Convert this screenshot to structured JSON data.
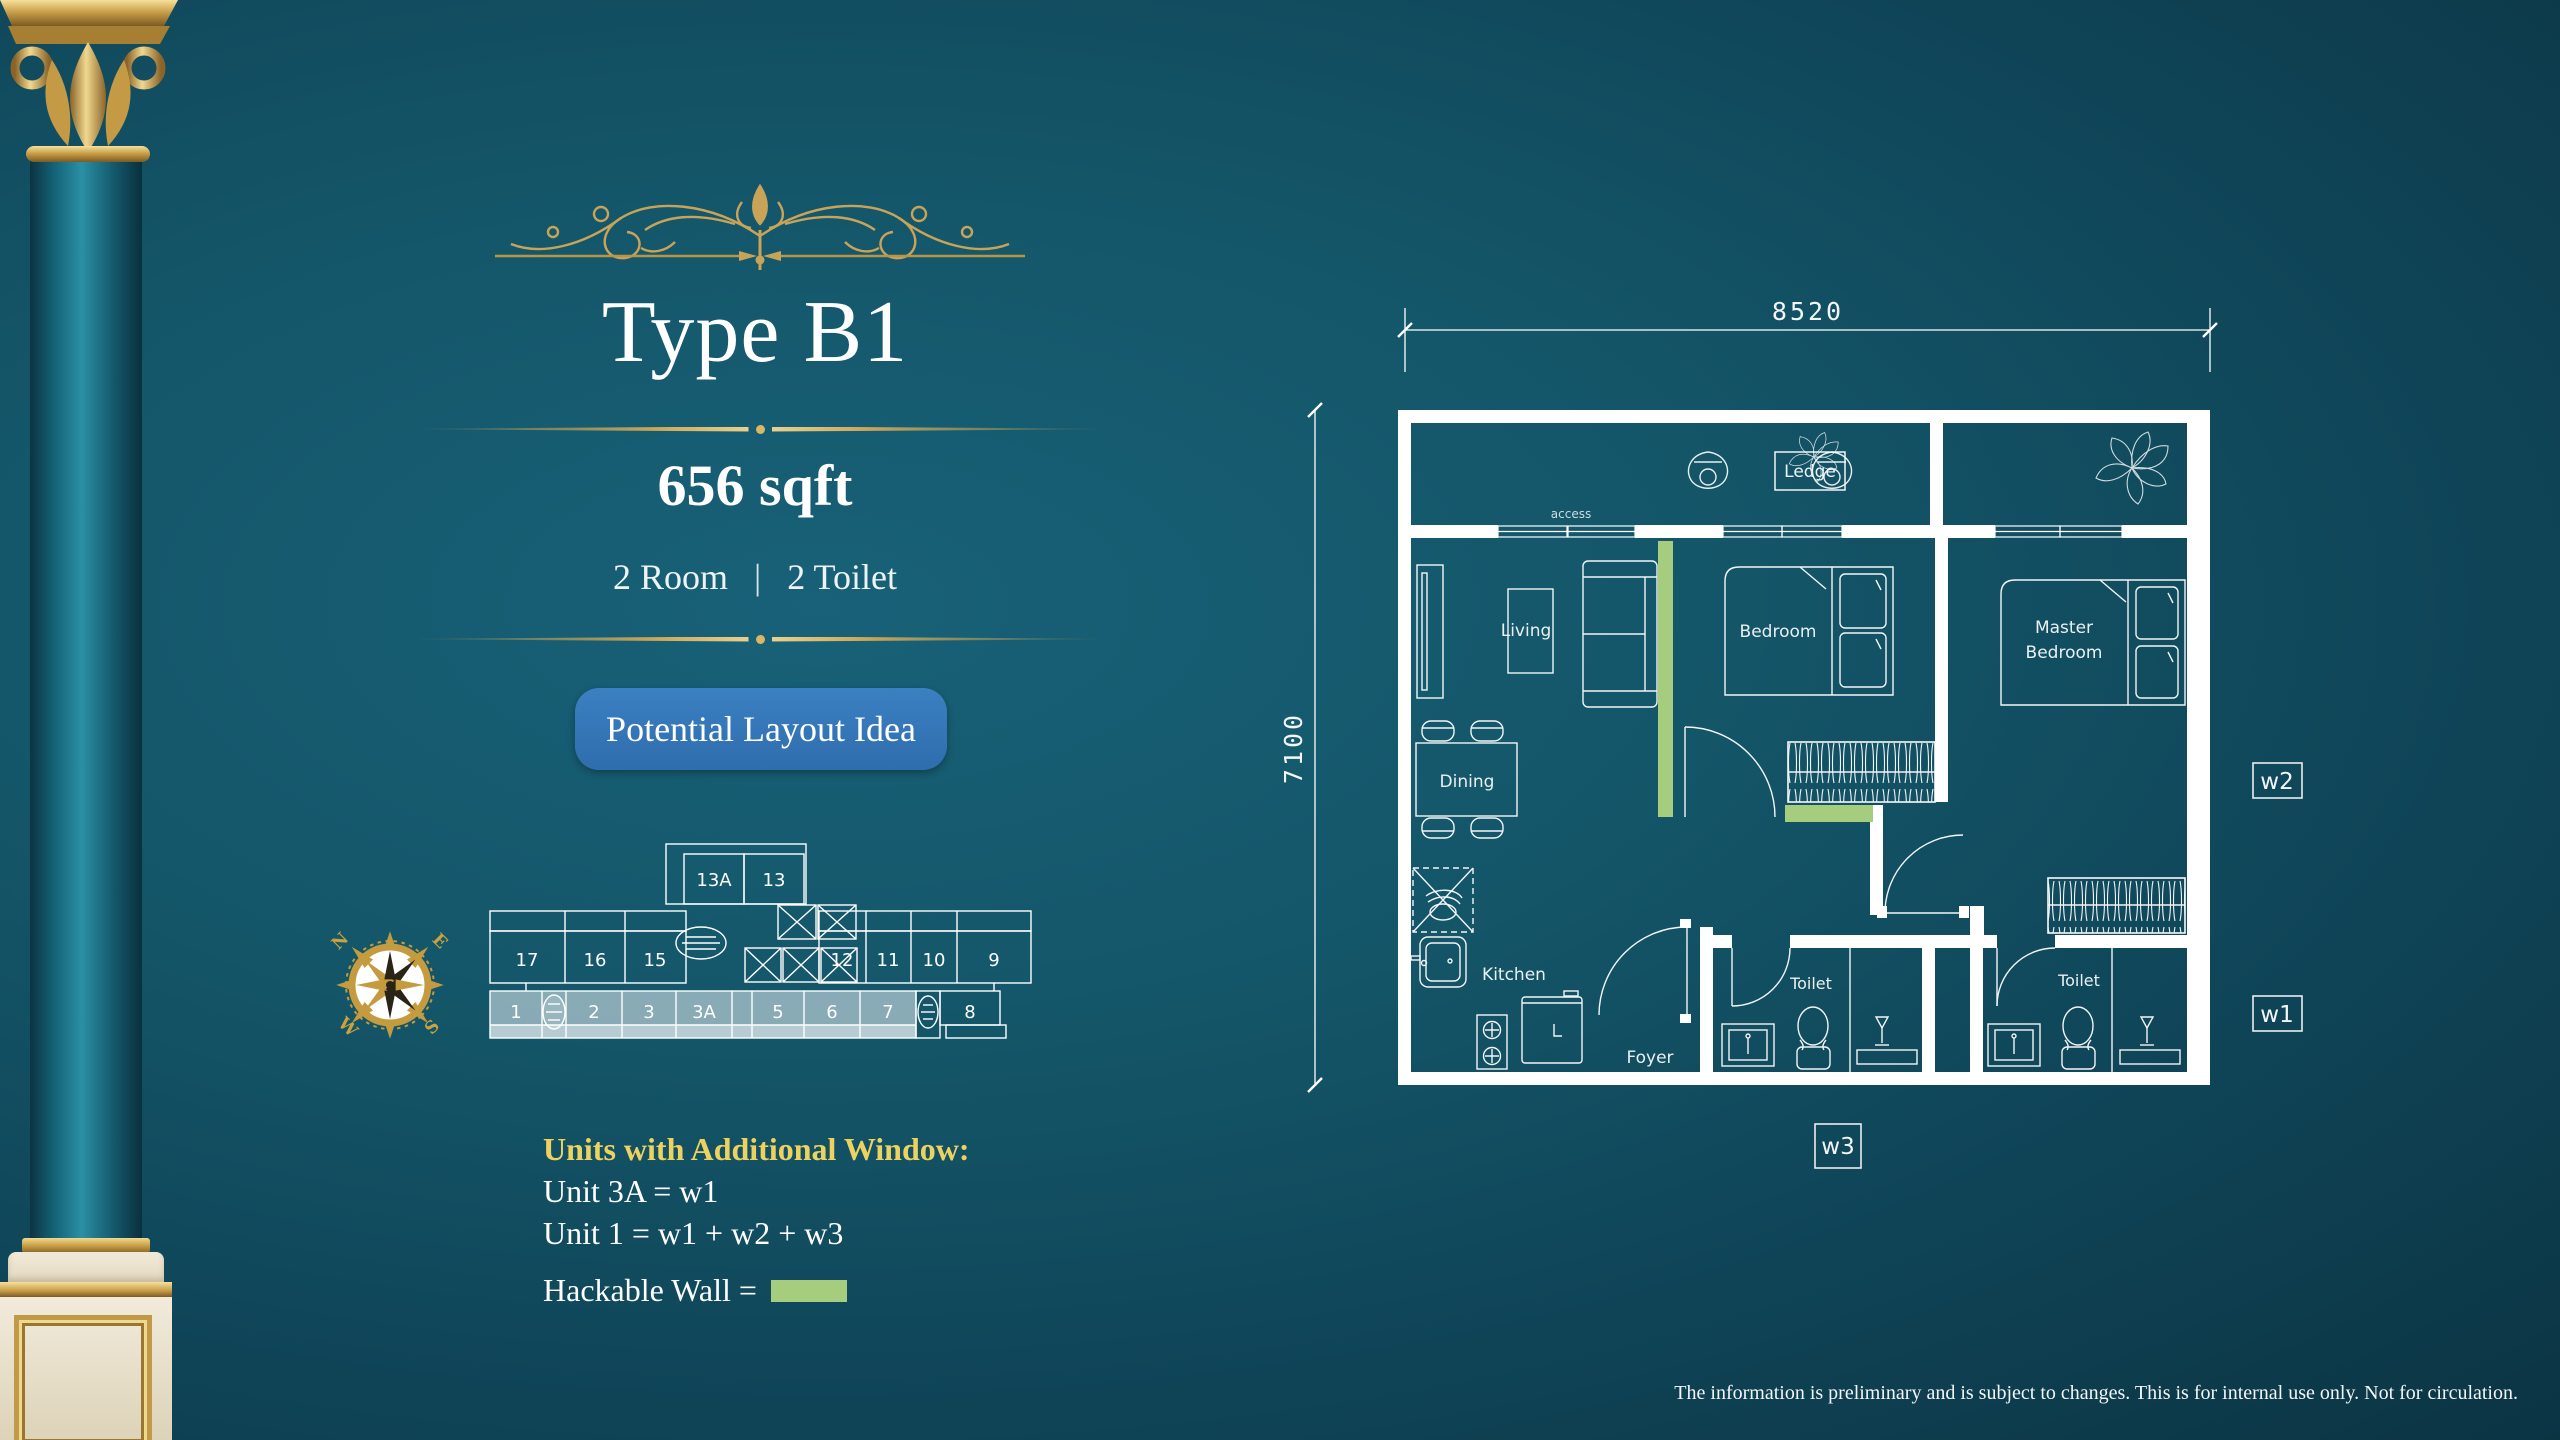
{
  "colors": {
    "background_dark": "#0b3443",
    "background_light": "#186178",
    "gold": "#c9a458",
    "heading_yellow": "#eed25f",
    "button_blue": "#3374b7",
    "hackable_green": "#a5cd7d",
    "unit_highlight": "#9cbac4",
    "plan_line": "#ffffff"
  },
  "header": {
    "title": "Type B1",
    "area": "656 sqft",
    "room_count": "2 Room",
    "separator": "|",
    "toilet_count": "2 Toilet",
    "button_label": "Potential Layout Idea"
  },
  "compass": {
    "north": "N",
    "east": "E",
    "south": "S",
    "west": "W"
  },
  "floor_plate": {
    "top_units": [
      "13A",
      "13"
    ],
    "mid_left_units": [
      "17",
      "16",
      "15"
    ],
    "mid_right_units": [
      "12",
      "11",
      "10",
      "9"
    ],
    "bottom_units": [
      "1",
      "2",
      "3",
      "3A",
      "5",
      "6",
      "7",
      "8"
    ],
    "highlighted_units": [
      "1",
      "2",
      "3",
      "3A",
      "5",
      "6",
      "7"
    ]
  },
  "notes": {
    "heading": "Units with Additional Window:",
    "line1": "Unit 3A = w1",
    "line2": "Unit 1 = w1 + w2 + w3",
    "hackable_label": "Hackable Wall ="
  },
  "floor_plan": {
    "dim_width": "8520",
    "dim_height": "7100",
    "labels": {
      "ledge": "Ledge",
      "access": "access",
      "living": "Living",
      "dining": "Dining",
      "kitchen": "Kitchen",
      "foyer": "Foyer",
      "bedroom": "Bedroom",
      "master_line1": "Master",
      "master_line2": "Bedroom",
      "toilet1": "Toilet",
      "toilet2": "Toilet",
      "w1": "w1",
      "w2": "w2",
      "w3": "w3"
    }
  },
  "footer": {
    "disclaimer": "The information is preliminary and is subject to changes. This is for internal use only. Not for circulation."
  }
}
